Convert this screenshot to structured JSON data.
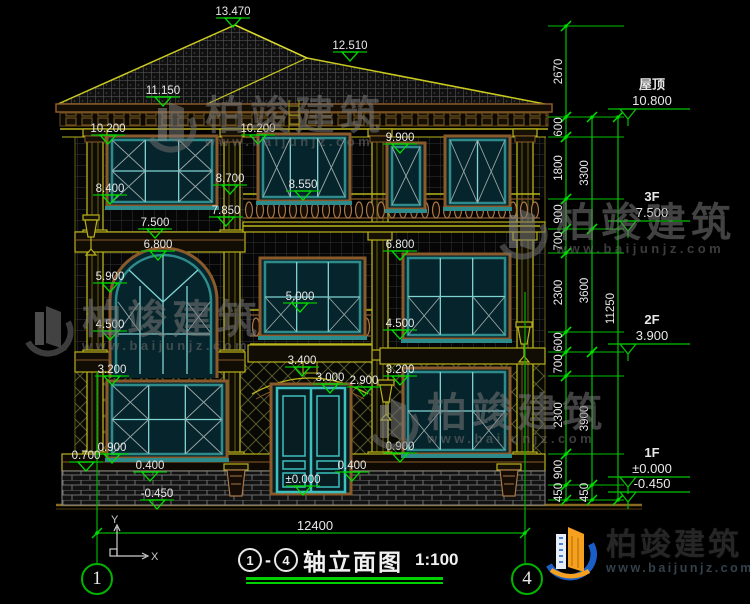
{
  "drawing": {
    "axis_left": "1",
    "axis_right": "4",
    "title_text": "轴立面图",
    "title_scale": "1:100",
    "bottom_dimension": "12400",
    "ucs": {
      "x": "X",
      "y": "Y"
    }
  },
  "watermark": {
    "name": "柏竣建筑",
    "url": "www.baijunjz.com"
  },
  "logo": {
    "name": "柏竣建筑",
    "url": "www.baijunjz.com"
  },
  "colors": {
    "dim_green": "#00c200",
    "text_white": "#e8e8e8",
    "structure_yellow": "#b9b31c",
    "roof_edge_yellow": "#c9c920",
    "trim_brown": "#8a5a2a",
    "window_teal": "#2e8b8b",
    "door_cyan": "#3fc0c0",
    "background": "#000000"
  },
  "floor_levels": [
    {
      "name": "屋顶",
      "value": "10.800",
      "y": 117
    },
    {
      "name": "3F",
      "value": "7.500",
      "y": 229
    },
    {
      "name": "2F",
      "value": "3.900",
      "y": 352
    },
    {
      "name": "1F",
      "value": "±0.000",
      "y": 485
    },
    {
      "name": "",
      "value": "-0.450",
      "y": 500
    }
  ],
  "extension_levels": [
    26,
    117,
    137,
    199,
    229,
    253,
    332,
    352,
    376,
    454,
    485,
    500
  ],
  "dim_chains": [
    {
      "x": 566,
      "segments": [
        {
          "y1": 26,
          "y2": 117,
          "label": "2670"
        },
        {
          "y1": 117,
          "y2": 137,
          "label": "600"
        },
        {
          "y1": 137,
          "y2": 199,
          "label": "1800"
        },
        {
          "y1": 199,
          "y2": 229,
          "label": "900"
        },
        {
          "y1": 229,
          "y2": 253,
          "label": "700"
        },
        {
          "y1": 253,
          "y2": 332,
          "label": "2300"
        },
        {
          "y1": 332,
          "y2": 352,
          "label": "600"
        },
        {
          "y1": 352,
          "y2": 376,
          "label": "700"
        },
        {
          "y1": 376,
          "y2": 454,
          "label": "2300"
        },
        {
          "y1": 454,
          "y2": 485,
          "label": "900"
        },
        {
          "y1": 485,
          "y2": 500,
          "label": "450"
        }
      ]
    },
    {
      "x": 592,
      "segments": [
        {
          "y1": 117,
          "y2": 229,
          "label": "3300"
        },
        {
          "y1": 229,
          "y2": 352,
          "label": "3600"
        },
        {
          "y1": 352,
          "y2": 485,
          "label": "3900"
        },
        {
          "y1": 485,
          "y2": 500,
          "label": "450"
        }
      ]
    },
    {
      "x": 618,
      "segments": [
        {
          "y1": 117,
          "y2": 500,
          "label": "11250"
        }
      ]
    }
  ],
  "elevation_markers": [
    {
      "value": "13.470",
      "x": 233,
      "y": 5
    },
    {
      "value": "12.510",
      "x": 350,
      "y": 39
    },
    {
      "value": "11.150",
      "x": 163,
      "y": 84
    },
    {
      "value": "10.200",
      "x": 108,
      "y": 122
    },
    {
      "value": "10.200",
      "x": 258,
      "y": 122
    },
    {
      "value": "9.900",
      "x": 400,
      "y": 131
    },
    {
      "value": "8.700",
      "x": 230,
      "y": 172
    },
    {
      "value": "8.550",
      "x": 303,
      "y": 178
    },
    {
      "value": "8.400",
      "x": 110,
      "y": 182
    },
    {
      "value": "7.850",
      "x": 226,
      "y": 204
    },
    {
      "value": "7.500",
      "x": 155,
      "y": 216
    },
    {
      "value": "6.800",
      "x": 158,
      "y": 238
    },
    {
      "value": "6.800",
      "x": 400,
      "y": 238
    },
    {
      "value": "5.900",
      "x": 110,
      "y": 270
    },
    {
      "value": "5.000",
      "x": 300,
      "y": 290
    },
    {
      "value": "4.500",
      "x": 110,
      "y": 318
    },
    {
      "value": "4.500",
      "x": 400,
      "y": 317
    },
    {
      "value": "3.400",
      "x": 302,
      "y": 354
    },
    {
      "value": "3.200",
      "x": 112,
      "y": 363
    },
    {
      "value": "3.200",
      "x": 400,
      "y": 363
    },
    {
      "value": "3.000",
      "x": 330,
      "y": 371
    },
    {
      "value": "2.900",
      "x": 364,
      "y": 374
    },
    {
      "value": "0.900",
      "x": 112,
      "y": 441
    },
    {
      "value": "0.900",
      "x": 400,
      "y": 440
    },
    {
      "value": "0.700",
      "x": 86,
      "y": 449
    },
    {
      "value": "0.400",
      "x": 150,
      "y": 459
    },
    {
      "value": "0.400",
      "x": 352,
      "y": 459
    },
    {
      "value": "±0.000",
      "x": 303,
      "y": 473
    },
    {
      "value": "-0.450",
      "x": 157,
      "y": 487
    }
  ]
}
